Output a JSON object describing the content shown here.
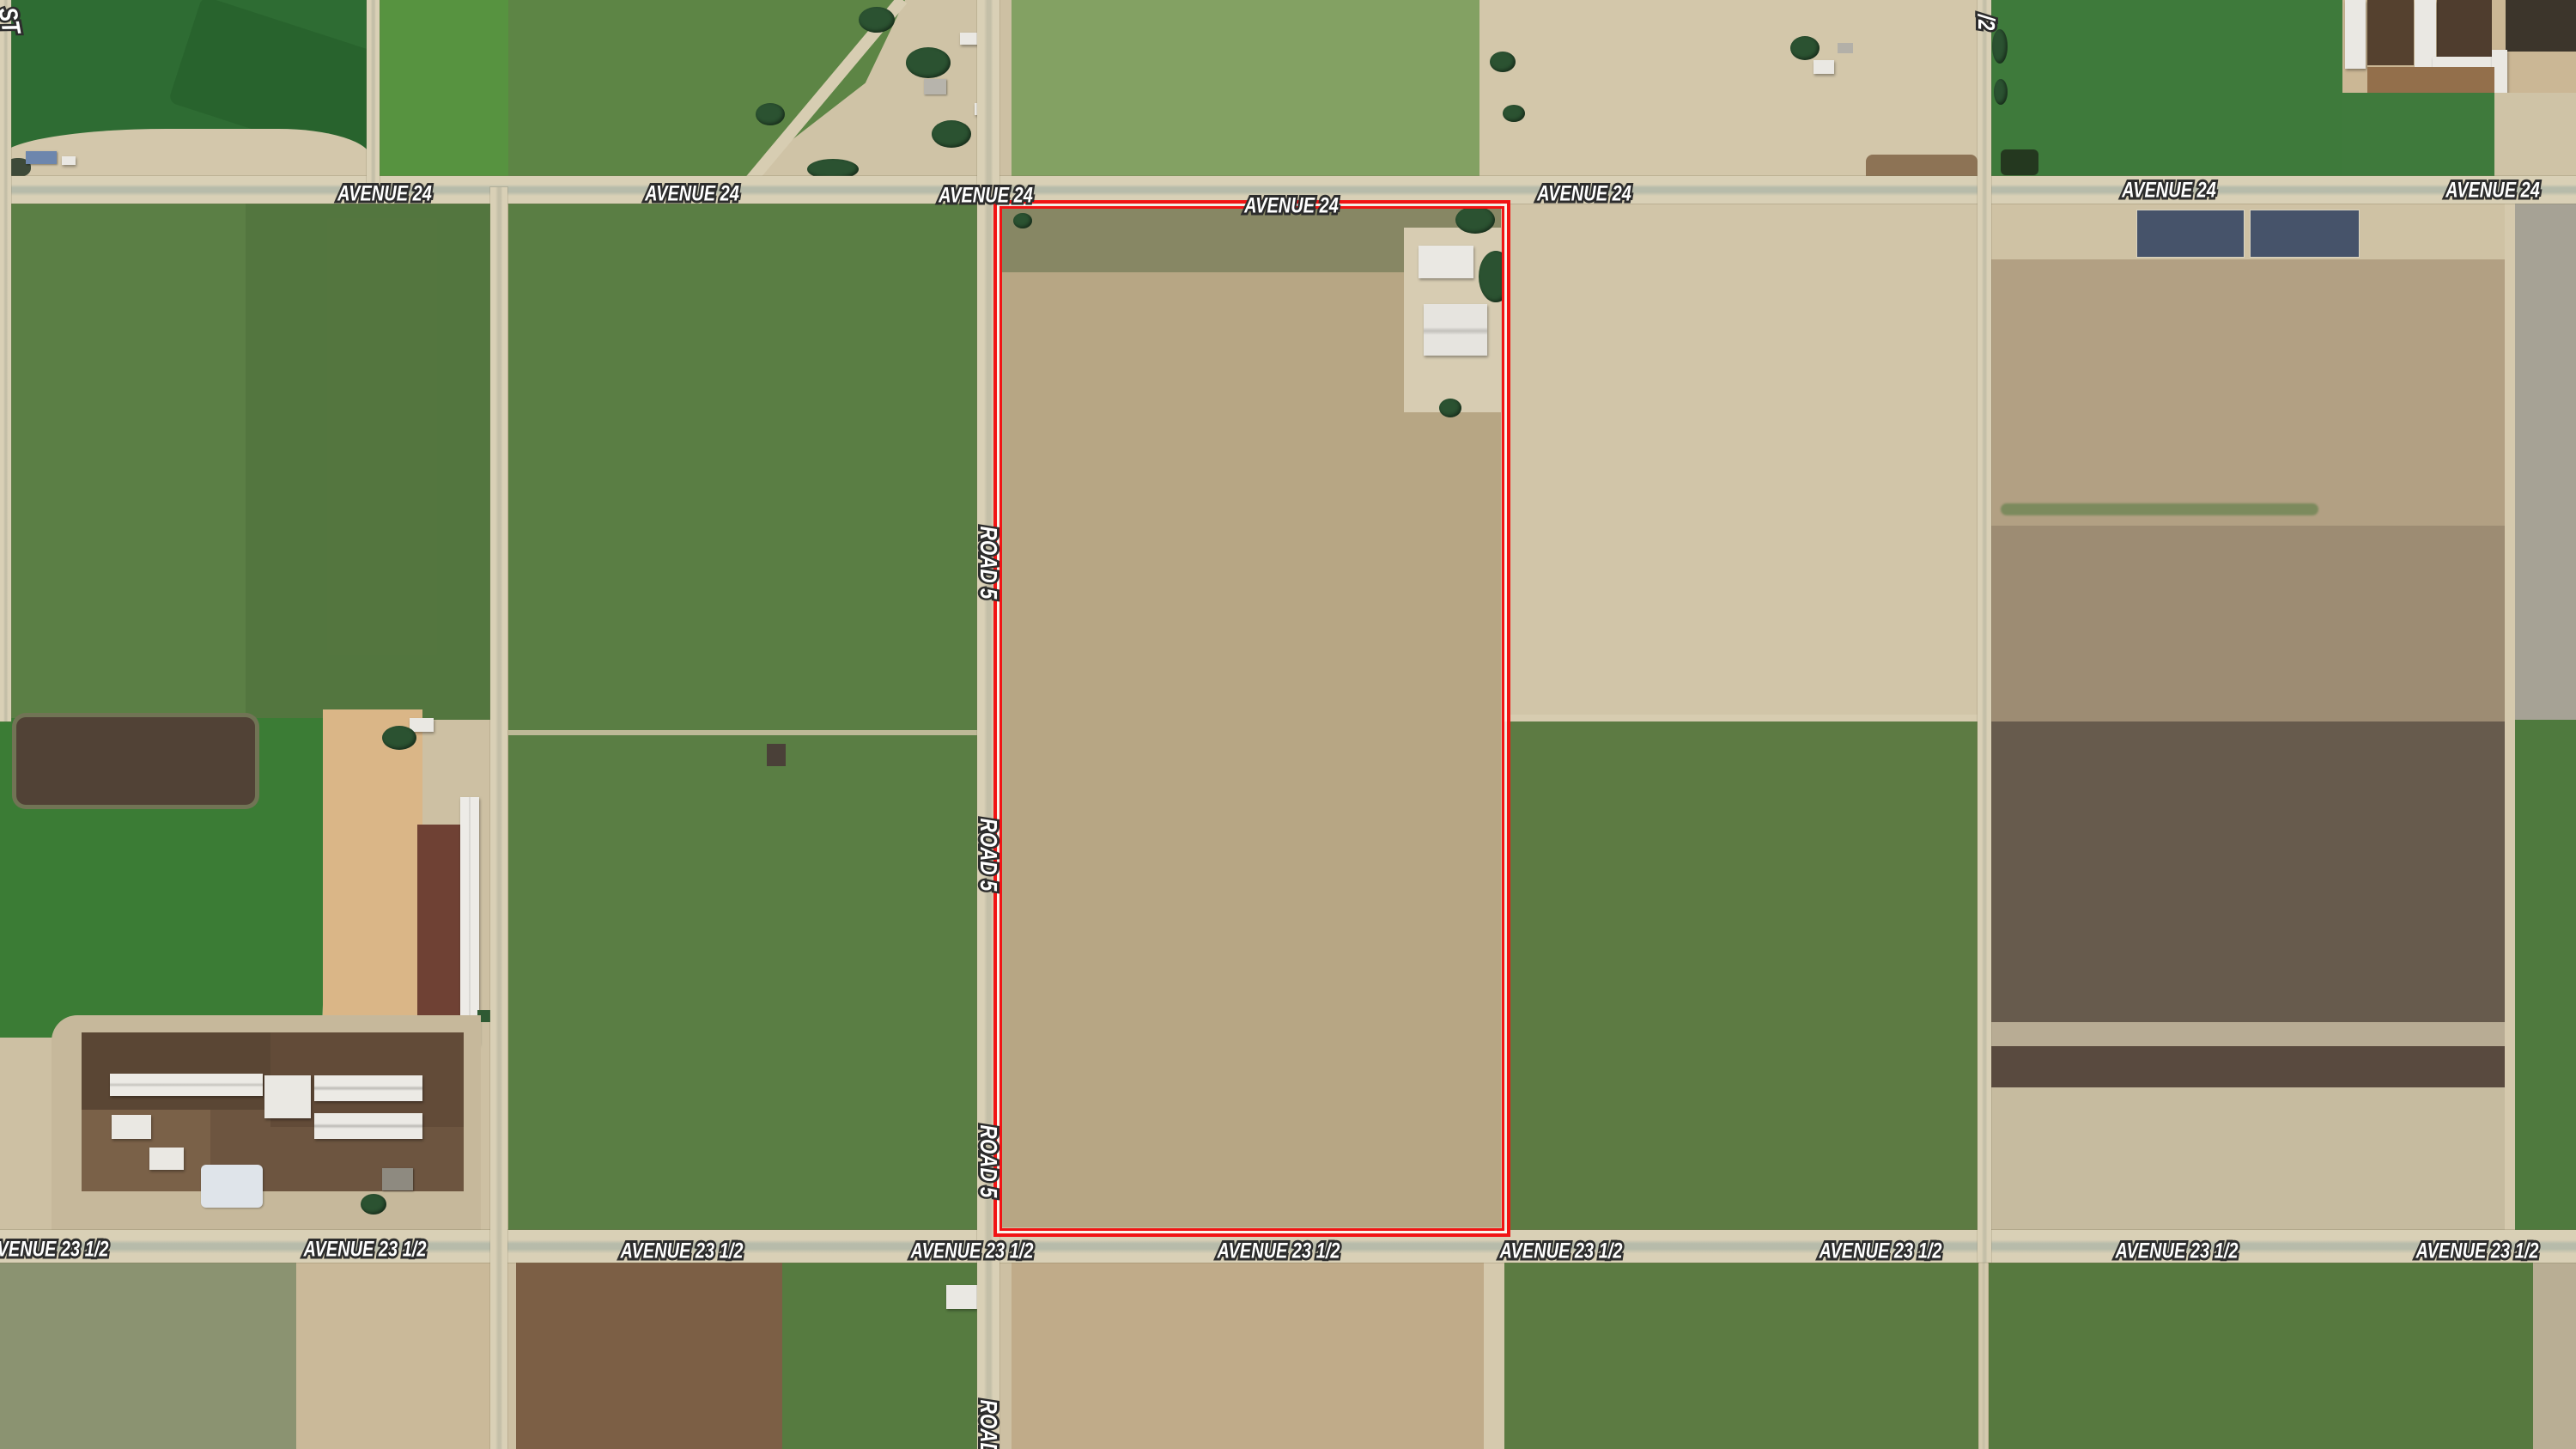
{
  "map": {
    "kind": "satellite-aerial-farmland",
    "roads": {
      "avenue_24": {
        "name": "AVENUE 24",
        "orientation": "horizontal"
      },
      "avenue_23_1_2": {
        "name": "AVENUE 23 1/2",
        "orientation": "horizontal"
      },
      "road_5": {
        "name": "ROAD 5",
        "orientation": "vertical"
      },
      "road_5_1_2_partial": {
        "name": "/2",
        "orientation": "vertical"
      },
      "street_partial": {
        "name": "ST",
        "orientation": "diagonal"
      }
    },
    "overlay": {
      "parcel_outline_color": "#f11414",
      "parcel_inner_line_color": "#fff8f3"
    },
    "label_style": {
      "text_color": "#ffffff",
      "halo_color": "#2e2e2e"
    },
    "terrain_colors": {
      "road_fill": "#d9d0b6",
      "bare_dirt": "#d1c5a8",
      "vineyard_green": "#5a7e44",
      "dark_field_green": "#2e6c33",
      "plowed_brown": "#9d8c73",
      "feedlot_brown": "#6d5540"
    }
  }
}
